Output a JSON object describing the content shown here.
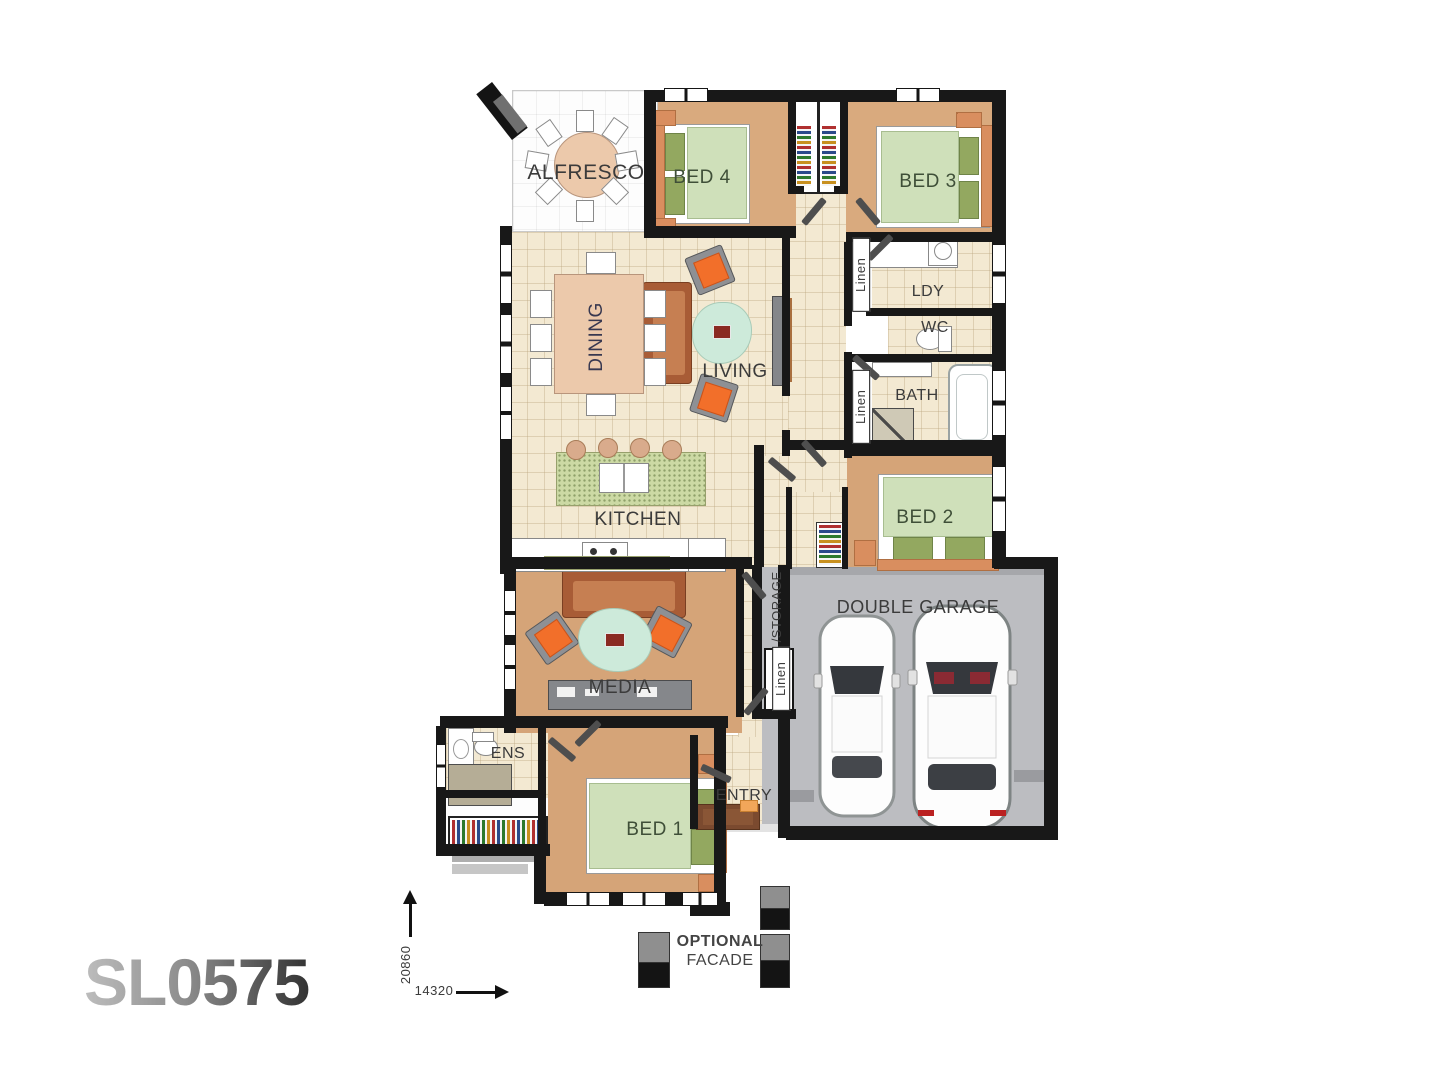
{
  "plan_code": "SL0575",
  "rooms": {
    "alfresco": "ALFRESCO",
    "bed4": "BED 4",
    "bed3": "BED 3",
    "dining": "DINING",
    "living": "LIVING",
    "linen_top": "Linen",
    "laundry": "LDY",
    "wc": "WC",
    "linen_mid": "Linen",
    "bath": "BATH",
    "kitchen": "KITCHEN",
    "bed2": "BED 2",
    "garage": "DOUBLE GARAGE",
    "storage": "/STORAGE",
    "storage_linen": "Linen",
    "media": "MEDIA",
    "ens": "ENS",
    "bed1": "BED 1",
    "entry": "ENTRY"
  },
  "facade_note": {
    "line1": "OPTIONAL",
    "line2": "FACADE"
  },
  "dimensions": {
    "depth_mm": "20860",
    "width_mm": "14320"
  },
  "colors": {
    "wall": "#181818",
    "floor_tile": "#f3e9d2",
    "floor_timber": "#d5a478",
    "garage_floor": "#bcbdc1",
    "bed_linen": "#cfe0ba",
    "accent_chair": "#f26f2a",
    "rug": "#cdeada"
  }
}
